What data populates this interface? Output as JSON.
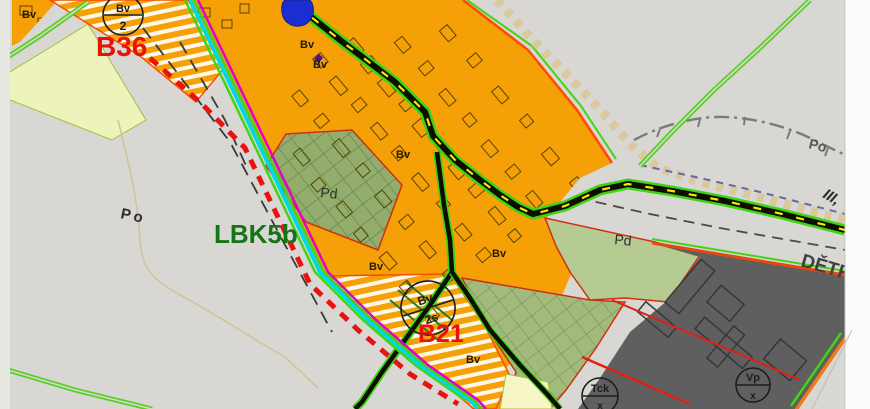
{
  "map": {
    "title": "zoning-plan-map-detail",
    "area_labels": {
      "b36": "B36",
      "b21": "B21",
      "lbk5b": "LBK5b",
      "po": "Po",
      "pd": "Pd",
      "bv": "Bv",
      "road_class": "III,",
      "settlement_edge": "DĚTŘ"
    },
    "symbols": {
      "bv2": {
        "top": "Bv",
        "bottom": "2"
      },
      "bv2s": {
        "top": "Bv",
        "bottom": "2s"
      },
      "vp": {
        "top": "Vp",
        "bottom": "x"
      },
      "tck": {
        "top": "Tck",
        "bottom": "x"
      }
    },
    "colors": {
      "background": "#d8d7d3",
      "built_area_orange": "#f5a006",
      "development_hatch_white": "#ffffff",
      "area_outline_red": "#f55000",
      "label_red": "#ea1208",
      "biocorridor_label_green": "#157515",
      "farmland_olive": "#93ad6d",
      "meadow_light_green": "#b6cb92",
      "industrial_dark_gray": "#5f5f5f",
      "pale_yellow_strip": "#eef3bb",
      "water_blue": "#1b2fd0",
      "road_edge_green": "#3fd314",
      "road_fill_black": "#0d0d00",
      "road_center_yellow": "#f5e800",
      "utility_cyan": "#00d8e8",
      "utility_magenta": "#e400c8",
      "boundary_red_dashed": "#e81210",
      "reserve_dotted_beige": "#d9c99c"
    }
  }
}
